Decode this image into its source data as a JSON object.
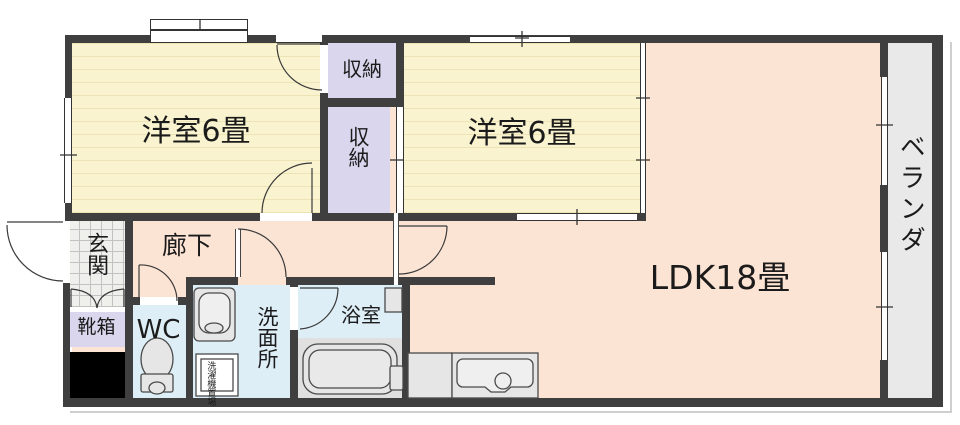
{
  "plan_title": "apartment-floor-plan",
  "rooms": {
    "bedroom1": {
      "label": "洋室6畳"
    },
    "bedroom2": {
      "label": "洋室6畳"
    },
    "ldk": {
      "label": "LDK18畳"
    },
    "closet_upper": {
      "label": "収納"
    },
    "closet_lower": {
      "label": "収納"
    },
    "genkan": {
      "label": "玄関"
    },
    "shoe_box": {
      "label": "靴箱"
    },
    "hallway": {
      "label": "廊下"
    },
    "wc": {
      "label": "WC"
    },
    "washroom": {
      "label": "洗面所"
    },
    "bathroom": {
      "label": "浴室"
    },
    "veranda": {
      "label": "ベランダ"
    },
    "laundry": {
      "label": "洗濯機置場",
      "line1": "洗濯機",
      "line2": "置場"
    }
  },
  "colors": {
    "wall": "#3f3f3f",
    "bedroom_fill": "#f9f3cf",
    "ldk_fill": "#fce4d4",
    "closet_fill": "#d9d6ed",
    "wet_area_fill": "#ddeef7",
    "veranda_fill": "#e9e9e9",
    "pillar_fill": "#000000",
    "fixture_fill": "#e6e6e6"
  }
}
